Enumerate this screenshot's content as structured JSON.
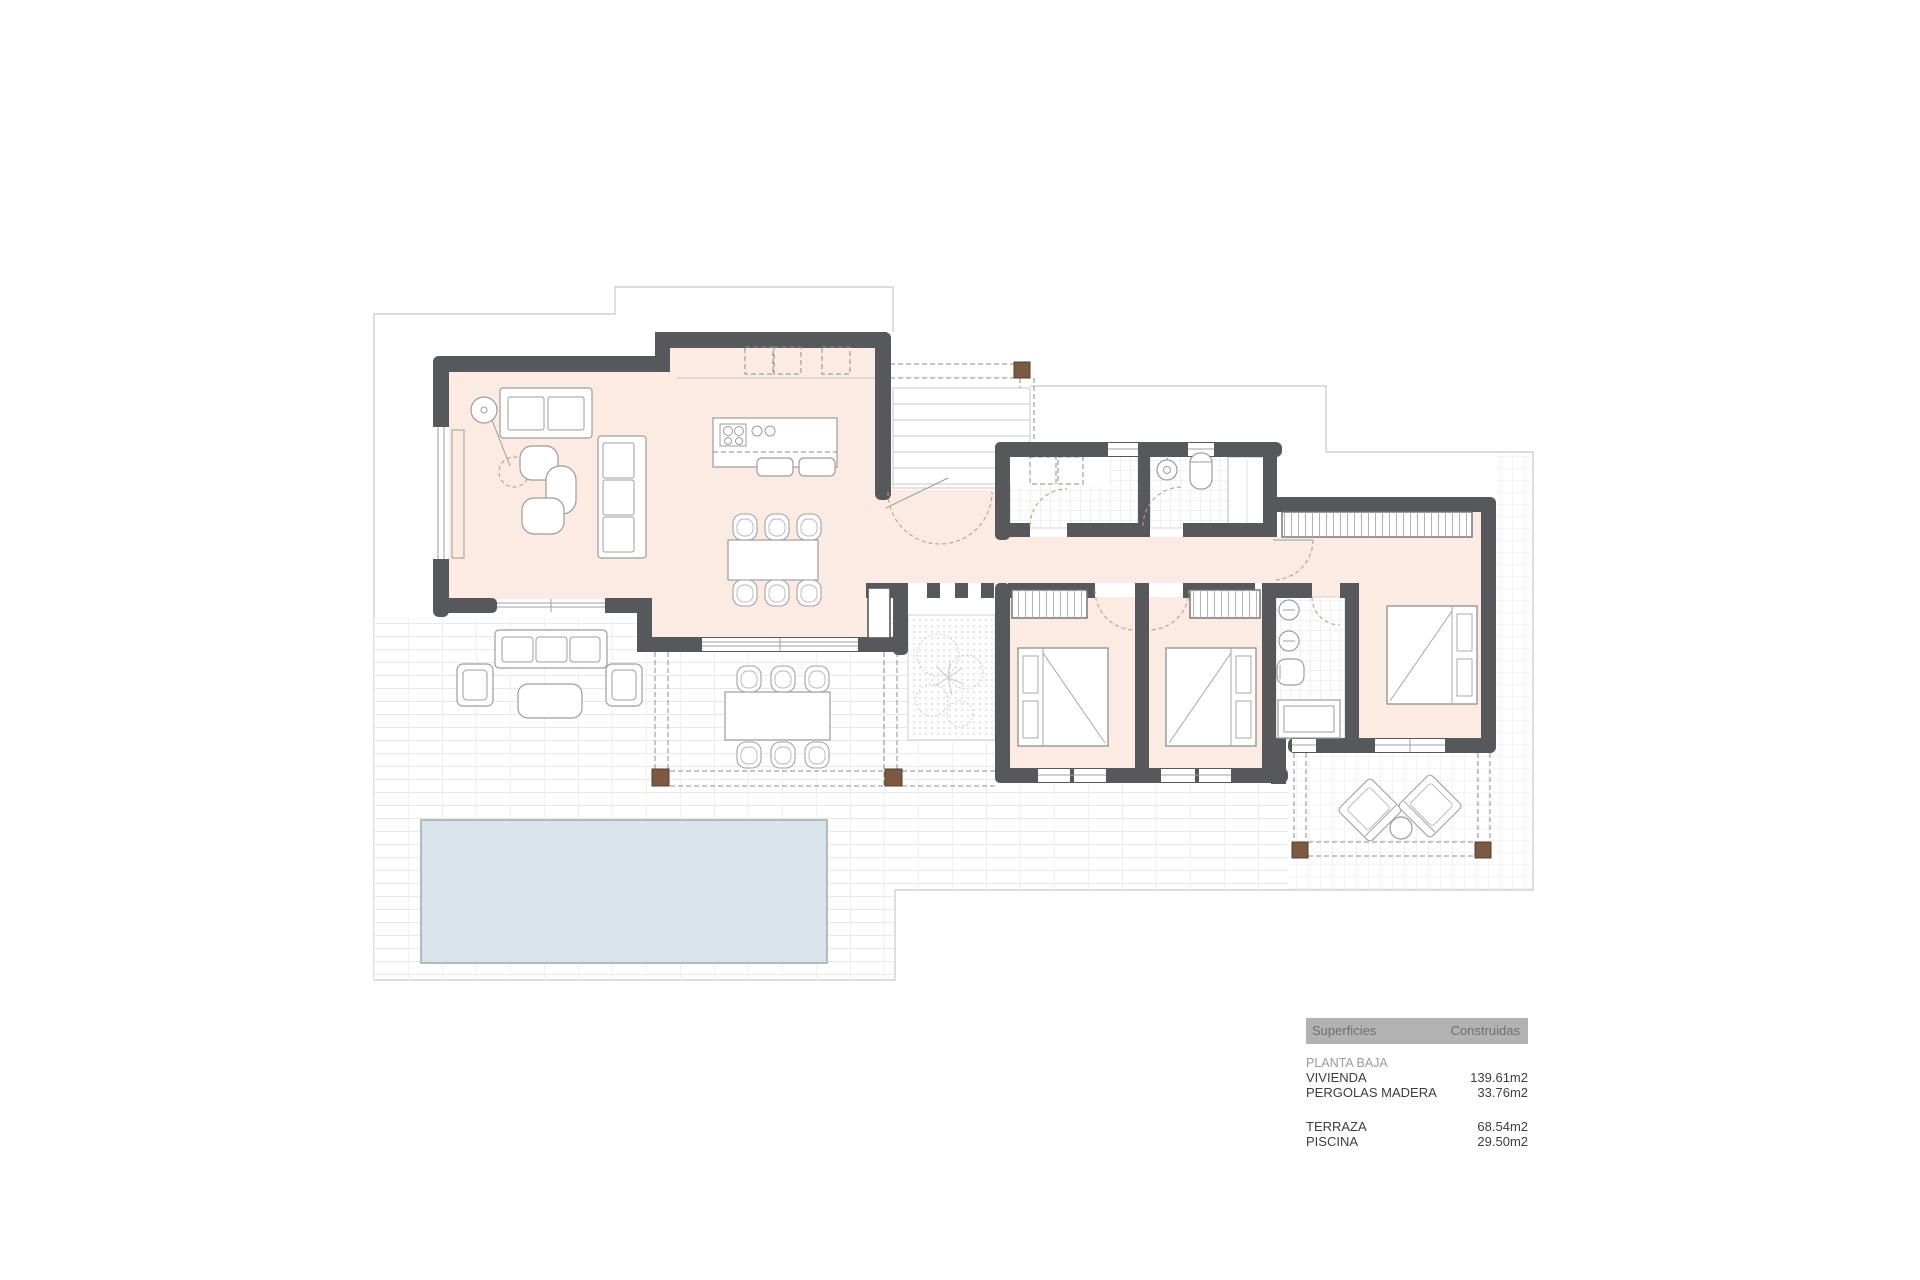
{
  "colors": {
    "wall": "#57585b",
    "floor": "#fcebe3",
    "poolfill": "#d8e4e8",
    "poolborder": "#a3aeb1",
    "postfill": "#7b5943",
    "postborder": "#553d2d",
    "boundary": "#c7c7c7",
    "furn": "#9c9c9c",
    "arc": "#c79a87",
    "legendbar": "#b2b2b2",
    "legendhead": "#6f6f6f",
    "text": "#3d3d3d",
    "muted": "#9b9b9b"
  },
  "legend": {
    "header": {
      "col1": "Superficies",
      "col2": "Construidas"
    },
    "section": "PLANTA BAJA",
    "groups": [
      {
        "rows": [
          {
            "label": "VIVIENDA",
            "value": "139.61m2"
          },
          {
            "label": "PERGOLAS MADERA",
            "value": "33.76m2"
          }
        ]
      },
      {
        "rows": [
          {
            "label": "TERRAZA",
            "value": "68.54m2"
          },
          {
            "label": "PISCINA",
            "value": "29.50m2"
          }
        ]
      }
    ]
  }
}
